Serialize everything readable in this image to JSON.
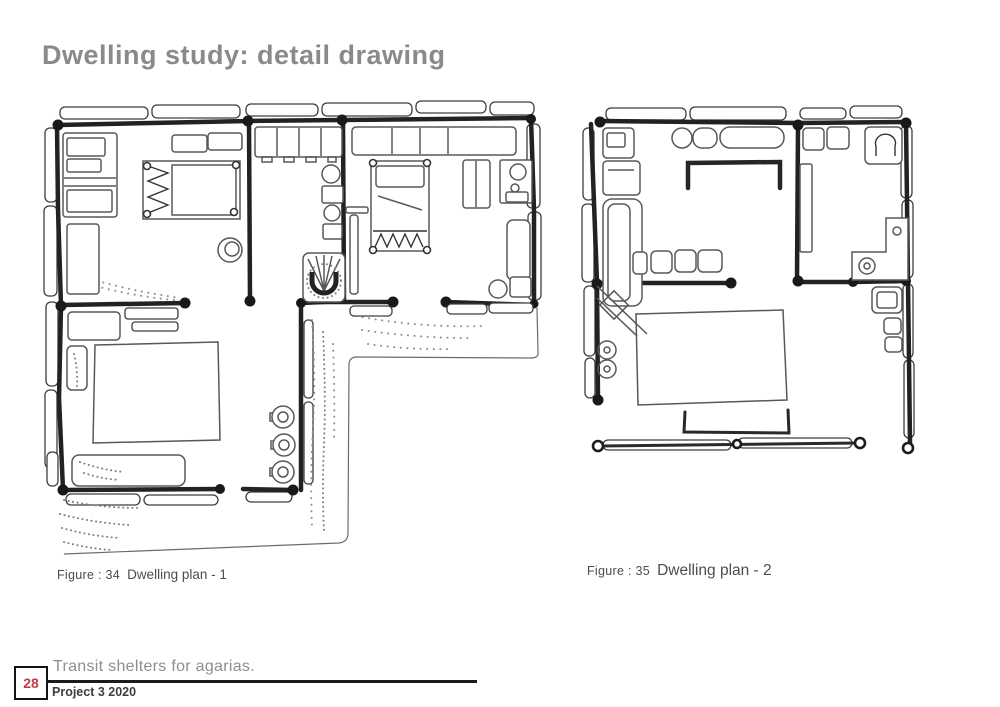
{
  "page": {
    "title": "Dwelling study: detail drawing"
  },
  "figures": [
    {
      "prefix": "Figure : 34",
      "label": "Dwelling plan - 1"
    },
    {
      "prefix": "Figure : 35",
      "label": "Dwelling plan - 2"
    }
  ],
  "footer": {
    "page_number": "28",
    "project_title": "Transit shelters for agarias.",
    "project_subtitle": "Project 3 2020"
  },
  "colors": {
    "title_gray": "#8a8a8a",
    "page_number_red": "#c13b4c",
    "ink": "#1d1d1d",
    "caption_gray": "#4d4d4d"
  }
}
